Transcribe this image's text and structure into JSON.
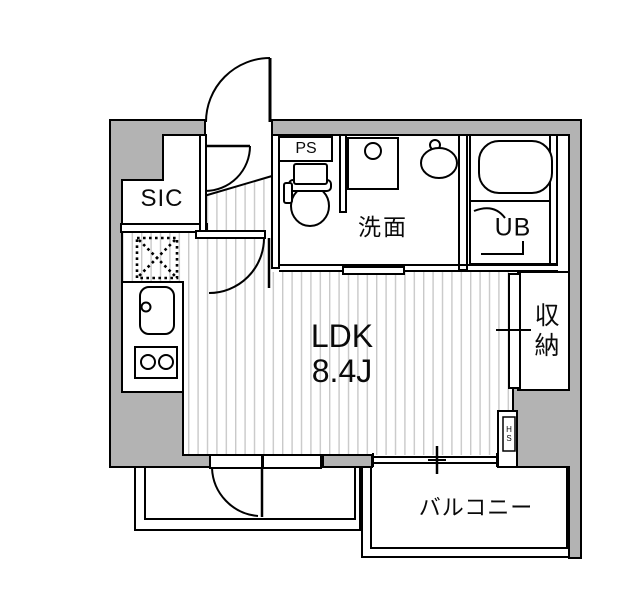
{
  "floorplan": {
    "labels": {
      "sic": "SIC",
      "ps": "PS",
      "washroom": "洗面",
      "unit_bath": "UB",
      "ldk_name": "LDK",
      "ldk_size": "8.4J",
      "storage": "収納",
      "balcony": "バルコニー",
      "hs": "HS"
    },
    "colors": {
      "wall-fill": "#b3b3b3",
      "line": "#000000",
      "floor-stripe": "#c9c9c9",
      "background": "#ffffff"
    },
    "fixtures": [
      "entrance-door",
      "interior-doors",
      "bathtub",
      "toilet",
      "wash-basin",
      "washing-machine-pan",
      "kitchen-sink",
      "gas-stove",
      "refrigerator-space",
      "sliding-door",
      "balcony-sliding-window",
      "storage-door",
      "hs-box"
    ]
  }
}
